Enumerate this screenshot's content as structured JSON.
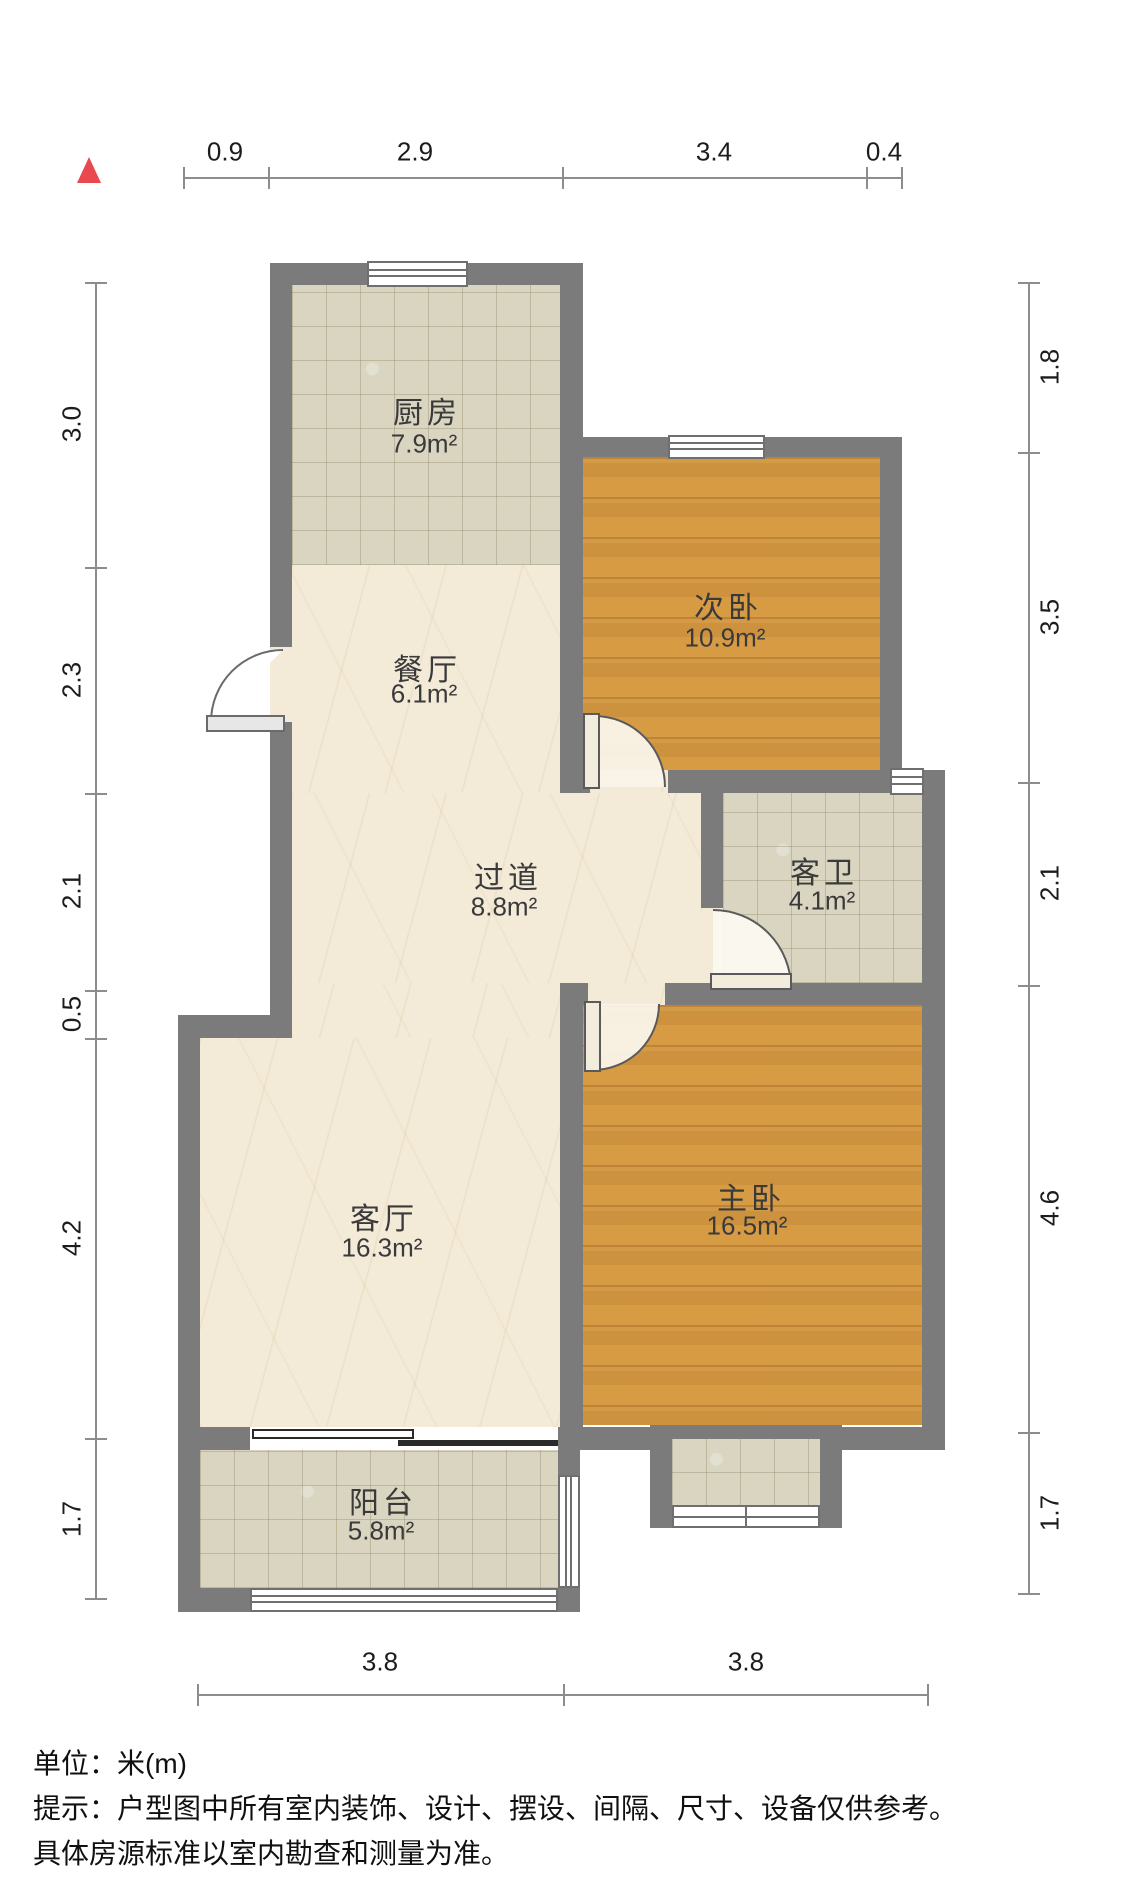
{
  "north_indicator": {
    "icon": "north-triangle",
    "color": "#e9484e"
  },
  "rooms": [
    {
      "id": "kitchen",
      "name": "厨房",
      "area": "7.9m²"
    },
    {
      "id": "dining",
      "name": "餐厅",
      "area": "6.1m²"
    },
    {
      "id": "bedroom2",
      "name": "次卧",
      "area": "10.9m²"
    },
    {
      "id": "hallway",
      "name": "过道",
      "area": "8.8m²"
    },
    {
      "id": "bathroom",
      "name": "客卫",
      "area": "4.1m²"
    },
    {
      "id": "living",
      "name": "客厅",
      "area": "16.3m²"
    },
    {
      "id": "master",
      "name": "主卧",
      "area": "16.5m²"
    },
    {
      "id": "balcony",
      "name": "阳台",
      "area": "5.8m²"
    }
  ],
  "dimensions": {
    "top": [
      "0.9",
      "2.9",
      "3.4",
      "0.4"
    ],
    "left": [
      "3.0",
      "2.3",
      "2.1",
      "0.5",
      "4.2",
      "1.7"
    ],
    "right": [
      "1.8",
      "3.5",
      "2.1",
      "4.6",
      "1.7"
    ],
    "bottom": [
      "3.8",
      "3.8"
    ]
  },
  "footer": {
    "line1": "单位：米(m)",
    "line2": "提示：户型图中所有室内装饰、设计、摆设、间隔、尺寸、设备仅供参考。",
    "line3": "具体房源标准以室内勘查和测量为准。"
  },
  "colors": {
    "wall": "#7b7b7b",
    "wood_floor": "#d79b44",
    "marble_floor": "#f3ead8",
    "tile_floor": "#d9d5c0",
    "north_accent": "#e9484e"
  }
}
